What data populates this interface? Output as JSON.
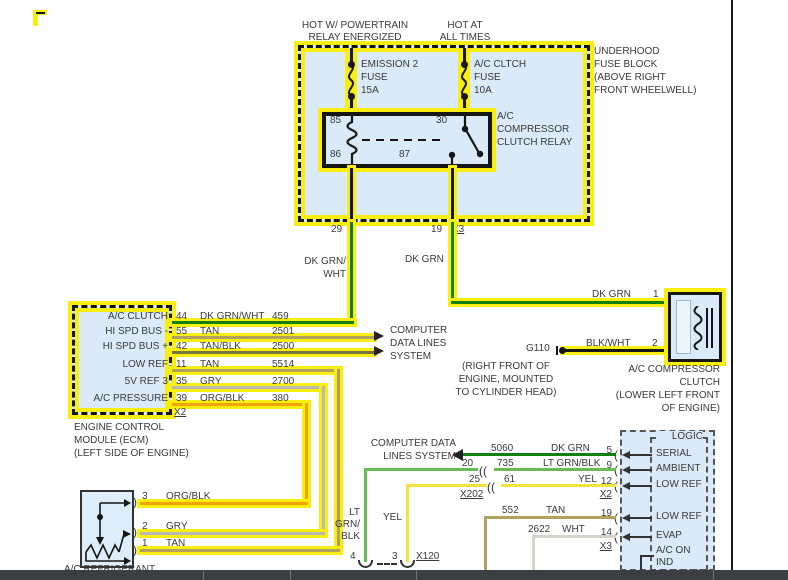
{
  "feeds": {
    "left": [
      "HOT W/ POWERTRAIN",
      "RELAY ENERGIZED"
    ],
    "right": [
      "HOT AT",
      "ALL TIMES"
    ]
  },
  "fuse_block": {
    "name": [
      "UNDERHOOD",
      "FUSE BLOCK",
      "(ABOVE RIGHT",
      "FRONT WHEELWELL)"
    ],
    "emission_fuse": [
      "EMISSION 2",
      "FUSE",
      "15A"
    ],
    "ac_fuse": [
      "A/C CLTCH",
      "FUSE",
      "10A"
    ]
  },
  "relay": {
    "name": [
      "A/C",
      "COMPRESSOR",
      "CLUTCH RELAY"
    ],
    "pin85": "85",
    "pin30": "30",
    "pin86": "86",
    "pin87": "87",
    "out_left_pin": "29",
    "out_right_pin": "19",
    "out_right_conn": "X3",
    "wire_left": [
      "DK GRN/",
      "WHT"
    ],
    "wire_right": "DK GRN"
  },
  "ecm": {
    "rows": [
      {
        "label": "A/C CLUTCH",
        "pin": "44",
        "color": "DK GRN/WHT",
        "circuit": "459"
      },
      {
        "label": "HI SPD BUS -",
        "pin": "55",
        "color": "TAN",
        "circuit": "2501"
      },
      {
        "label": "HI SPD BUS +",
        "pin": "42",
        "color": "TAN/BLK",
        "circuit": "2500"
      },
      {
        "label": "LOW REF",
        "pin": "11",
        "color": "TAN",
        "circuit": "5514"
      },
      {
        "label": "5V REF 3",
        "pin": "35",
        "color": "GRY",
        "circuit": "2700"
      },
      {
        "label": "A/C PRESSURE",
        "pin": "39",
        "color": "ORG/BLK",
        "circuit": "380"
      }
    ],
    "connector": "X2",
    "name": [
      "ENGINE CONTROL",
      "MODULE (ECM)",
      "(LEFT SIDE OF ENGINE)"
    ]
  },
  "data_lines_top": [
    "COMPUTER",
    "DATA LINES",
    "SYSTEM"
  ],
  "data_lines_bottom": [
    "COMPUTER DATA",
    "LINES SYSTEM"
  ],
  "ground": {
    "id": "G110",
    "location": [
      "(RIGHT FRONT OF",
      "ENGINE, MOUNTED",
      "TO CYLINDER HEAD)"
    ],
    "wire": "BLK/WHT",
    "pin": "2"
  },
  "clutch": {
    "wire": "DK GRN",
    "pin": "1",
    "name": [
      "A/C COMPRESSOR",
      "CLUTCH",
      "(LOWER LEFT FRONT",
      "OF ENGINE)"
    ]
  },
  "hvac": {
    "title": "LOGIC",
    "rows": [
      {
        "pin": "5",
        "label": "SERIAL",
        "circuit": "5060",
        "color": "DK GRN"
      },
      {
        "pin": "9",
        "label": "AMBIENT",
        "circuit": "735",
        "color": "LT GRN/BLK",
        "splice": "20"
      },
      {
        "pin": "12",
        "label": "LOW REF",
        "circuit": "61",
        "color": "YEL",
        "splice": "25"
      },
      {
        "pin": "19",
        "label": "LOW REF",
        "circuit": "552",
        "color": "TAN"
      },
      {
        "pin": "14",
        "label": "EVAP",
        "circuit": "2622",
        "color": "WHT"
      }
    ],
    "conn_x2": "X2",
    "conn_x3": "X3",
    "splice_conn": "X202",
    "ind": [
      "A/C ON",
      "IND"
    ]
  },
  "vert_labels": {
    "ltgrnblk": [
      "LT",
      "GRN/",
      "BLK"
    ],
    "yel": "YEL"
  },
  "x120": {
    "id": "X120",
    "pin_left": "4",
    "pin_right": "3"
  },
  "sensor": {
    "rows": [
      {
        "pin": "3",
        "color": "ORG/BLK"
      },
      {
        "pin": "2",
        "color": "GRY"
      },
      {
        "pin": "1",
        "color": "TAN"
      }
    ],
    "name": "A/C REFRIGERANT"
  },
  "colors": {
    "highlight": "#f8ee10",
    "dk_grn": "#12800f",
    "lt_grn": "#66bb55",
    "yel": "#f2e33c",
    "tan": "#b0a15e",
    "tan_blk": "#7a7140",
    "gry": "#b8b8b8",
    "org_blk": "#f2a30a",
    "wht": "#d8d3c8",
    "blk": "#161616",
    "box_fill": "#daeaf8"
  }
}
